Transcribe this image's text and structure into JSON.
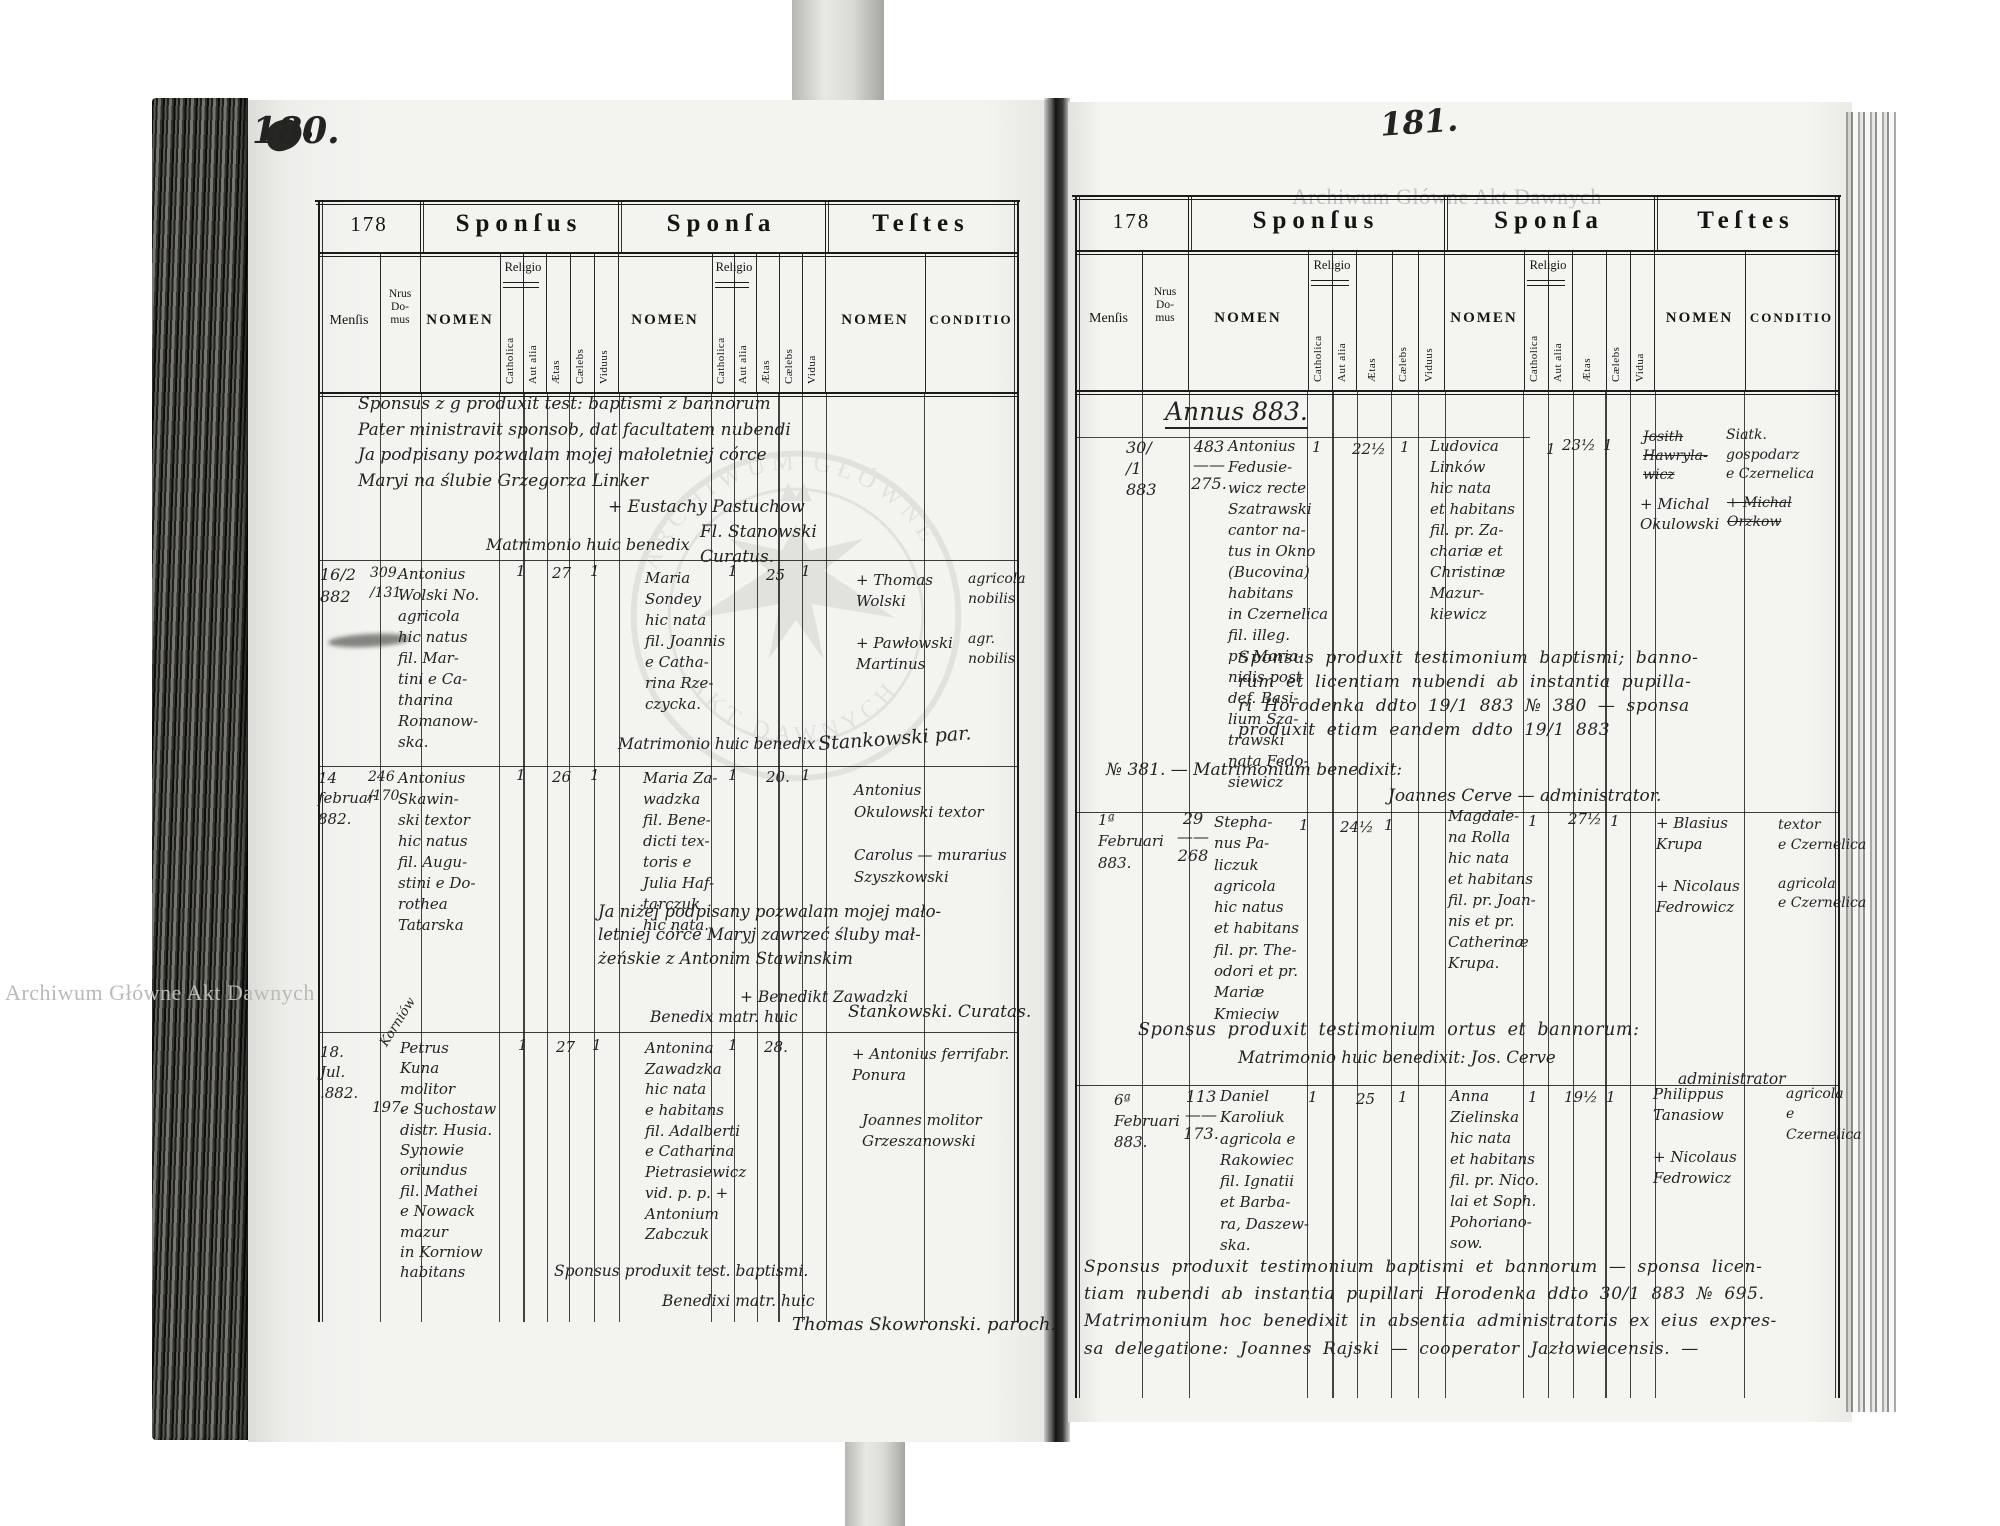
{
  "watermark": {
    "text": "Archiwum Główne Akt Dawnych",
    "emblem_top": "ARCHIWUM GŁÓWNE",
    "emblem_bottom": "AKT DAWNYCH"
  },
  "form": {
    "no": "178",
    "sponsus": "Sponſus",
    "sponsa": "Sponſa",
    "testes": "Teſtes",
    "mensis": "Menſis",
    "nrus": "Nrus\nDo-\nmus",
    "nomen": "NOMEN",
    "religio": "Religio",
    "catholica": "Catholica",
    "aut_alia": "Aut alia",
    "aetas": "Ætas",
    "caelebs": "Cælebs",
    "viduus": "Viduus",
    "vidua": "Vidua",
    "conditio": "CONDITIO"
  },
  "page_left": {
    "folio": "180.",
    "top_note": "Sponsus z g produxit test: baptismi z bannorum\nPater ministravit sponsob, dat facultatem nubendi\nJa podpisany pozwalam mojej małoletniej córce\nMaryi na ślubie Grzegorza Linker",
    "top_note_witness": "+ Eustachy Pastuchow",
    "top_note_benedix": "Matrimonio huic benedix",
    "top_note_sign": "Fl. Stanowski\n   Curatus.",
    "entries": [
      {
        "mensis": "16/2\n 882",
        "nrus": "309,\n /131.",
        "sponsus_nomen": "Antonius\nWolski No.\nagricola\nhic natus\nfil. Mar-\ntini e Ca-\ntharina\nRomanow-\nska.",
        "sponsus_catholica": "1",
        "sponsus_aetas": "27",
        "sponsus_caelebs": "1",
        "sponsa_nomen": "Maria\nSondey\nhic nata\nfil. Joannis\ne Catha-\nrina Rze-\nczycka.",
        "sponsa_catholica": "1",
        "sponsa_aetas": "25",
        "sponsa_caelebs": "1",
        "testes_nomen": "+ Thomas\n   Wolski\n\n+ Pawłowski\n   Martinus",
        "conditio": "agricola\nnobilis\n\nagr.\nnobilis",
        "benedictio": "Matrimonio huic benedix",
        "signature": "Stankowski par."
      },
      {
        "mensis": "14\nfebruar\n882.",
        "nrus": "246\n/170",
        "sponsus_nomen": "Antonius\nSkawin-\nski textor\nhic natus\nfil. Augu-\nstini e Do-\nrothea\nTatarska",
        "sponsus_catholica": "1",
        "sponsus_aetas": "26",
        "sponsus_caelebs": "1",
        "sponsa_nomen": "Maria Za-\nwadzka\nfil. Bene-\ndicti tex-\ntoris e\nJulia Haf-\ntarczuk\nhic nata.",
        "sponsa_catholica": "1",
        "sponsa_aetas": "20.",
        "sponsa_caelebs": "1",
        "testes_nomen": "Antonius\nOkulowski  textor\n\nCarolus — murarius\nSzyszkowski",
        "consent_note": "Ja niżej podpisany pozwalam mojej mało-\nletniej córce Maryj zawrzeć śluby mał-\nżeńskie z Antonim Stawinskim",
        "consent_witness": "+ Benedikt Zawadzki",
        "benedictio": "Benedix matr. huic",
        "signature": "Stankowski. Curatas."
      },
      {
        "mensis": "18.\nJul.\n.882.",
        "nrus_place": "Korniów",
        "nrus": "197.",
        "sponsus_nomen": "Petrus\nKuna\nmolitor\ne Suchostaw\ndistr. Husia.\nSynowie\noriundus\nfil. Mathei\ne Nowack\nmazur\nin Korniow\nhabitans",
        "sponsus_catholica": "1",
        "sponsus_aetas": "27",
        "sponsus_caelebs": "1",
        "sponsa_nomen": "Antonina\nZawadzka\nhic nata\ne habitans\nfil. Adalberti\ne Catharina\nPietrasiewicz\nvid. p. p. +\nAntonium\nZabczuk",
        "sponsa_catholica": "1",
        "sponsa_aetas": "28.",
        "testes_nomen": "+ Antonius    ferrifabr.\n   Ponura",
        "testes_nomen2": "Joannes    molitor\nGrzeszanowski",
        "note_baptismi": "Sponsus produxit test. baptismi.",
        "benedictio": "Benedixi matr. huic",
        "signature": "Thomas Skowronski. paroch."
      }
    ]
  },
  "page_right": {
    "folio": "181.",
    "annus": "Annus 883.",
    "entries": [
      {
        "mensis": "30/\n/1\n883",
        "nrus": "483\n——\n275.",
        "sponsus_nomen": "Antonius\nFedusie-\nwicz recte\nSzatrawski\ncantor na-\ntus in Okno\n(Bucovina)\nhabitans\nin Czernelica\nfil. illeg.\npr. Maria-\nnidis post\ndef. Basi-\nlium Sza-\ntrawski\nnata Fedo-\nsiewicz",
        "sponsus_catholica": "1",
        "sponsus_aetas": "22½",
        "sponsus_caelebs": "1",
        "sponsa_nomen": "Ludovica\nLinków\nhic nata\net habitans\nfil. pr. Za-\nchariæ et\nChristinæ\nMazur-\nkiewicz",
        "sponsa_catholica": "1",
        "sponsa_aetas": "23½",
        "sponsa_caelebs": "1",
        "testes_struck": "Josith\nHawryla-\nwicz",
        "testes_nomen": "+ Michal\nOkulowski",
        "conditio": "Siatk.\ngospodarz\ne Czernelica",
        "conditio_struck": "+ Michal\nOrzkow",
        "note": "Sponsus produxit testimonium baptismi; banno-\nrum et licentiam nubendi ab instantia pupilla-\nri Horodenka ddto 19/1 883 № 380 —  sponsa\nproduxit etiam eandem ddto 19/1 883",
        "note2": "№ 381. —  Matrimonium benedixit:",
        "note3": "Joannes Cerve — administrator."
      },
      {
        "mensis": "1ª\nFebruari\n883.",
        "nrus": "29\n——\n268",
        "sponsus_nomen": "Stepha-\nnus Pa-\nliczuk\nagricola\nhic natus\net habitans\nfil. pr. The-\nodori et pr.\nMariæ\nKmieciw",
        "sponsus_catholica": "1",
        "sponsus_aetas": "24½",
        "sponsus_caelebs": "1",
        "sponsa_nomen": "Magdale-\nna Rolla\nhic nata\net habitans\nfil. pr. Joan-\nnis et pr.\nCatherinæ\nKrupa.",
        "sponsa_catholica": "1",
        "sponsa_aetas": "27½",
        "sponsa_caelebs": "1",
        "testes_nomen": "+ Blasius\n   Krupa\n\n+ Nicolaus\nFedrowicz",
        "conditio": "textor\ne Czernelica\n\nagricola\ne Czernelica",
        "note": "Sponsus produxit testimonium ortus et bannorum:",
        "note2": "Matrimonio huic benedixit:    Jos. Cerve",
        "note3": "administrator"
      },
      {
        "mensis": "6ª\nFebruari\n883.",
        "nrus": "113\n——\n173.",
        "sponsus_nomen": "Daniel\nKaroliuk\nagricola e\nRakowiec\nfil. Ignatii\net Barba-\nra, Daszew-\nska.",
        "sponsus_catholica": "1",
        "sponsus_aetas": "25",
        "sponsus_caelebs": "1",
        "sponsa_nomen": "Anna\nZielinska\nhic nata\net habitans\nfil. pr. Nico.\nlai et Soph.\nPohoriano-\nsow.",
        "sponsa_catholica": "1",
        "sponsa_aetas": "19½",
        "sponsa_caelebs": "1",
        "testes_nomen": "Philippus\nTanasiow\n\n+ Nicolaus\nFedrowicz",
        "conditio": "agricola\ne\nCzernelica",
        "note": "Sponsus produxit testimonium baptismi et bannorum —  sponsa licen-\ntiam nubendi ab instantia pupillari Horodenka ddto 30/1 883 № 695.\nMatrimonium hoc benedixit in absentia administratoris ex eius expres-\nsa delegatione:  Joannes Rajski — cooperator Jazłowiecensis. —"
      }
    ]
  }
}
